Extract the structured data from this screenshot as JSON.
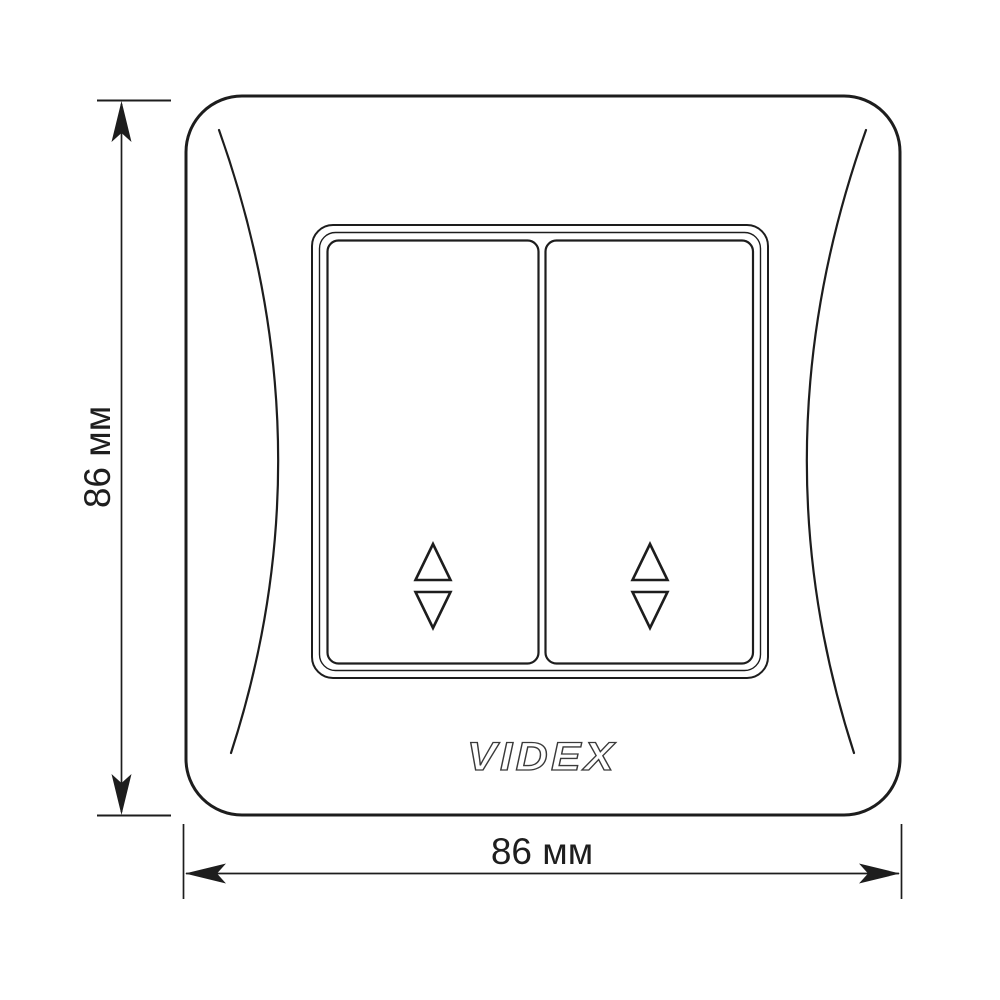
{
  "product_drawing": {
    "brand_logo_text": "VIDEX",
    "switch_module": {
      "rocker_count": 2,
      "rockers": [
        {
          "position": "left",
          "icon": "up-down-triangles"
        },
        {
          "position": "right",
          "icon": "up-down-triangles"
        }
      ]
    }
  },
  "dimensions": {
    "height_label": "86 мм",
    "width_label": "86 мм"
  },
  "colors": {
    "line": "#1d1d1d",
    "background": "#ffffff",
    "logo_outline": "#3a3a3a",
    "label_text": "#1e1e1e"
  }
}
